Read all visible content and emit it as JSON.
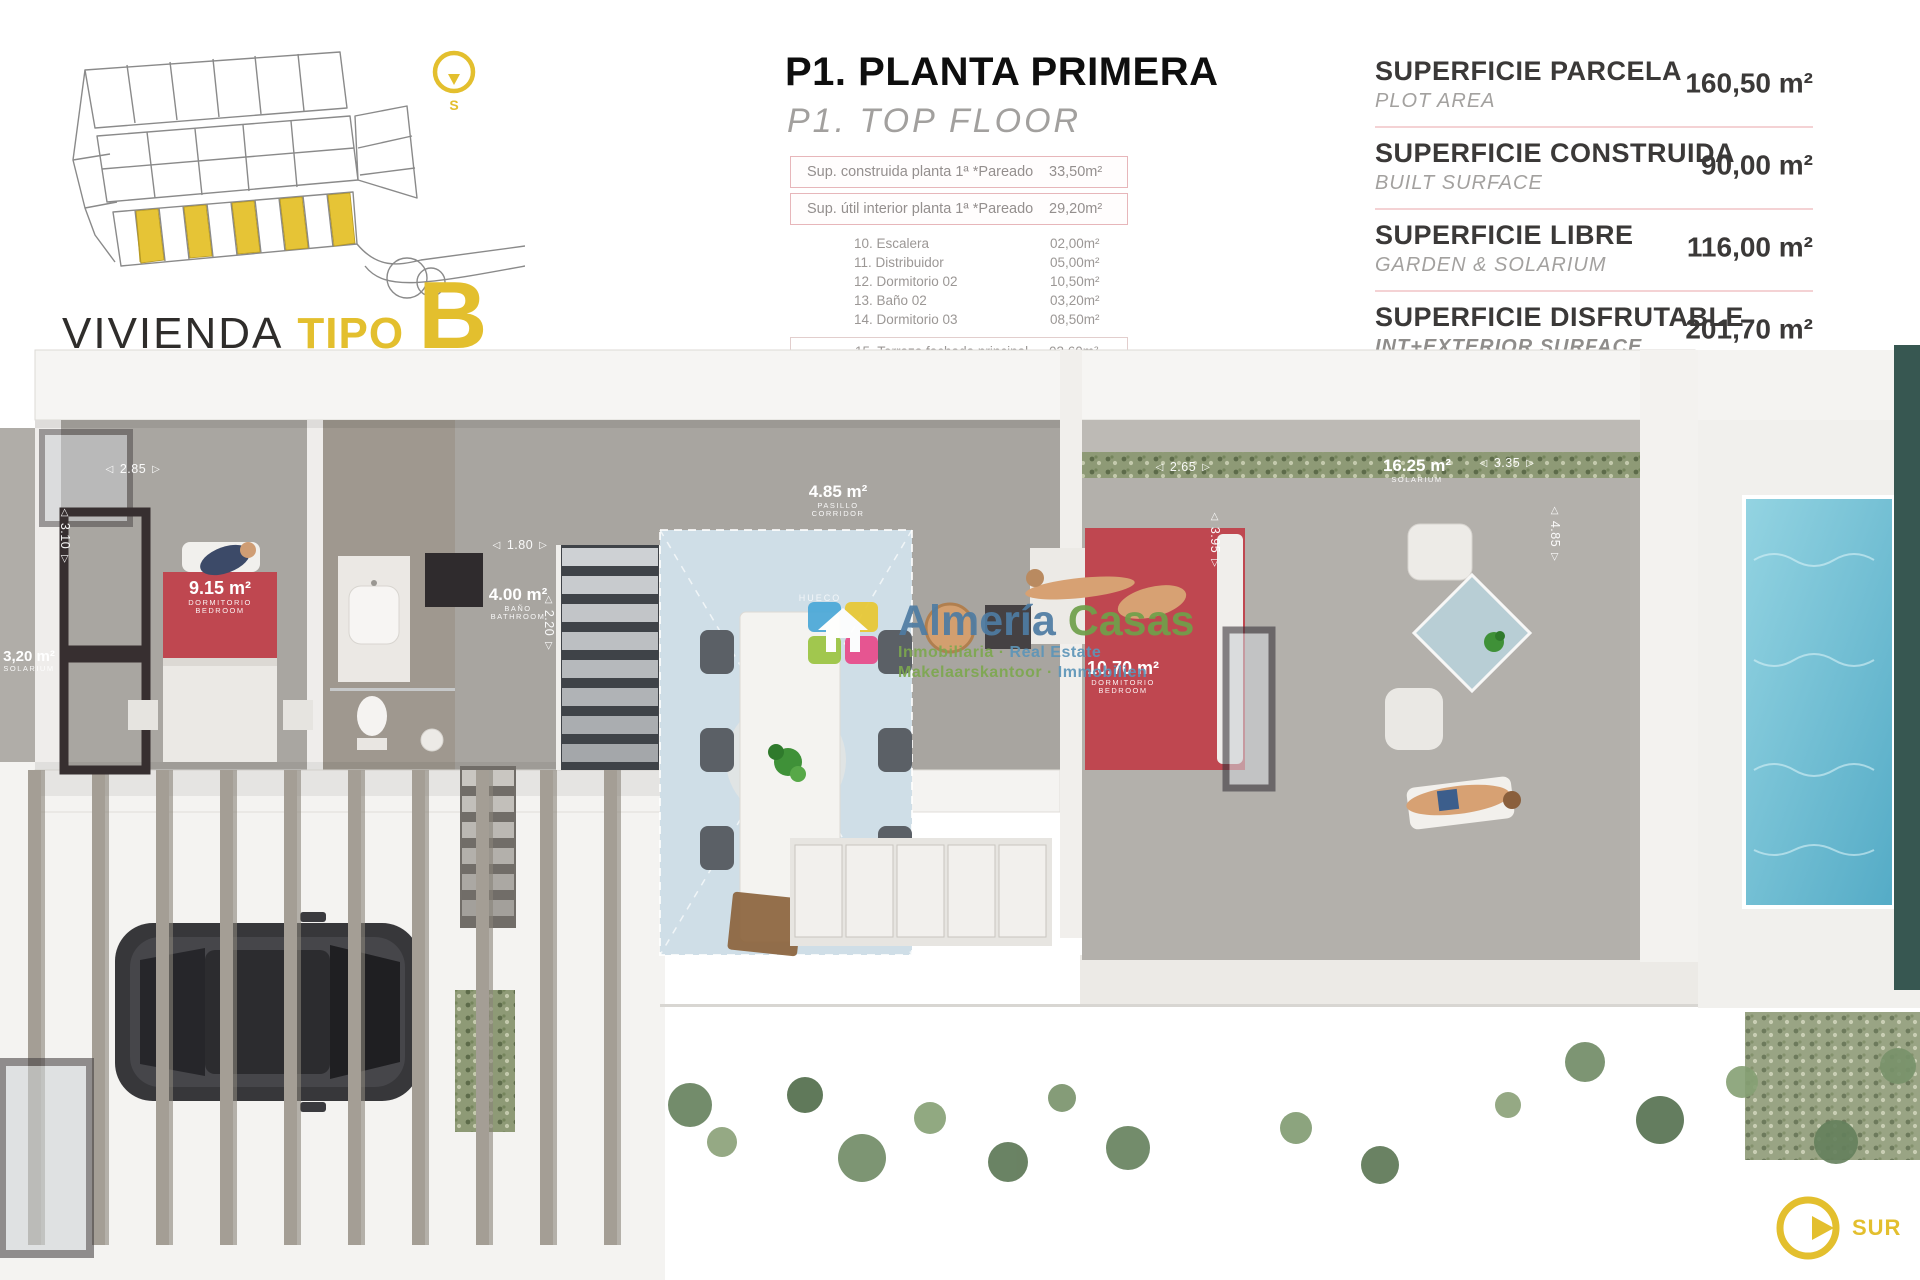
{
  "header": {
    "variant_title": {
      "prefix": "VIVIENDA",
      "middle": "TIPO",
      "letter": "B"
    },
    "floor_title": "P1. PLANTA PRIMERA",
    "floor_subtitle": "P1. TOP FLOOR",
    "site_plan": {
      "compass_letter": "S"
    }
  },
  "areas_table": {
    "header_rows": [
      {
        "label": "Sup. construida planta 1ª *Pareado",
        "value": "33,50m²"
      },
      {
        "label": "Sup. útil interior planta 1ª *Pareado",
        "value": "29,20m²"
      }
    ],
    "rooms": [
      {
        "label": "10. Escalera",
        "value": "02,00m²"
      },
      {
        "label": "11. Distribuidor",
        "value": "05,00m²"
      },
      {
        "label": "12. Dormitorio 02",
        "value": "10,50m²"
      },
      {
        "label": "13. Baño 02",
        "value": "03,20m²"
      },
      {
        "label": "14. Dormitorio 03",
        "value": "08,50m²"
      }
    ],
    "exterior_group": {
      "label": "exterior",
      "rows": [
        {
          "label": "15. Terraza fachada principal",
          "value": "03,60m²"
        },
        {
          "label": "16. Terraza fachada trasera",
          "value": "15,90m²"
        }
      ]
    }
  },
  "summary": {
    "rows": [
      {
        "title": "SUPERFICIE PARCELA",
        "subtitle": "PLOT AREA",
        "value": "160,50 m²"
      },
      {
        "title": "SUPERFICIE CONSTRUIDA",
        "subtitle": "BUILT SURFACE",
        "value": "90,00 m²"
      },
      {
        "title": "SUPERFICIE LIBRE",
        "subtitle": "GARDEN & SOLARIUM",
        "value": "116,00 m²"
      },
      {
        "title": "SUPERFICIE DISFRUTABLE",
        "subtitle": "INT+EXTERIOR SURFACE",
        "value": "201,70 m²"
      }
    ]
  },
  "plan": {
    "rooms": [
      {
        "area": "3,20 m²",
        "name": "SOLARIUM"
      },
      {
        "area": "9.15 m²",
        "name": "DORMITORIO",
        "name_en": "BEDROOM"
      },
      {
        "area": "4.00 m²",
        "name": "BAÑO",
        "name_en": "BATHROOM"
      },
      {
        "area": "4.85 m²",
        "name": "PASILLO",
        "name_en": "CORRIDOR"
      },
      {
        "area": "10.70 m²",
        "name": "DORMITORIO",
        "name_en": "BEDROOM"
      },
      {
        "area": "16.25 m²",
        "name": "SOLARIUM"
      }
    ],
    "void_label": "HUECO",
    "dimensions": [
      "2.85",
      "3.10",
      "1.80",
      "2.20",
      "2.65",
      "3.95",
      "3.35",
      "4.85"
    ],
    "compass": {
      "label": "SUR"
    }
  },
  "watermark": {
    "brand_a": "Almería",
    "brand_b": "Casas",
    "line1_a": "Inmobiliaria ·",
    "line1_b": " Real Estate",
    "line2_a": "Makelaarskantoor ·",
    "line2_b": " Immobilien"
  },
  "icons": {
    "dim_arrow_left": "◁",
    "dim_arrow_right": "▷"
  },
  "colors": {
    "accent_yellow": "#e3bf2e",
    "table_border_pink": "#e7b6ba",
    "bed_red": "#bf4750",
    "pool_blue": "#6fbcd2"
  }
}
